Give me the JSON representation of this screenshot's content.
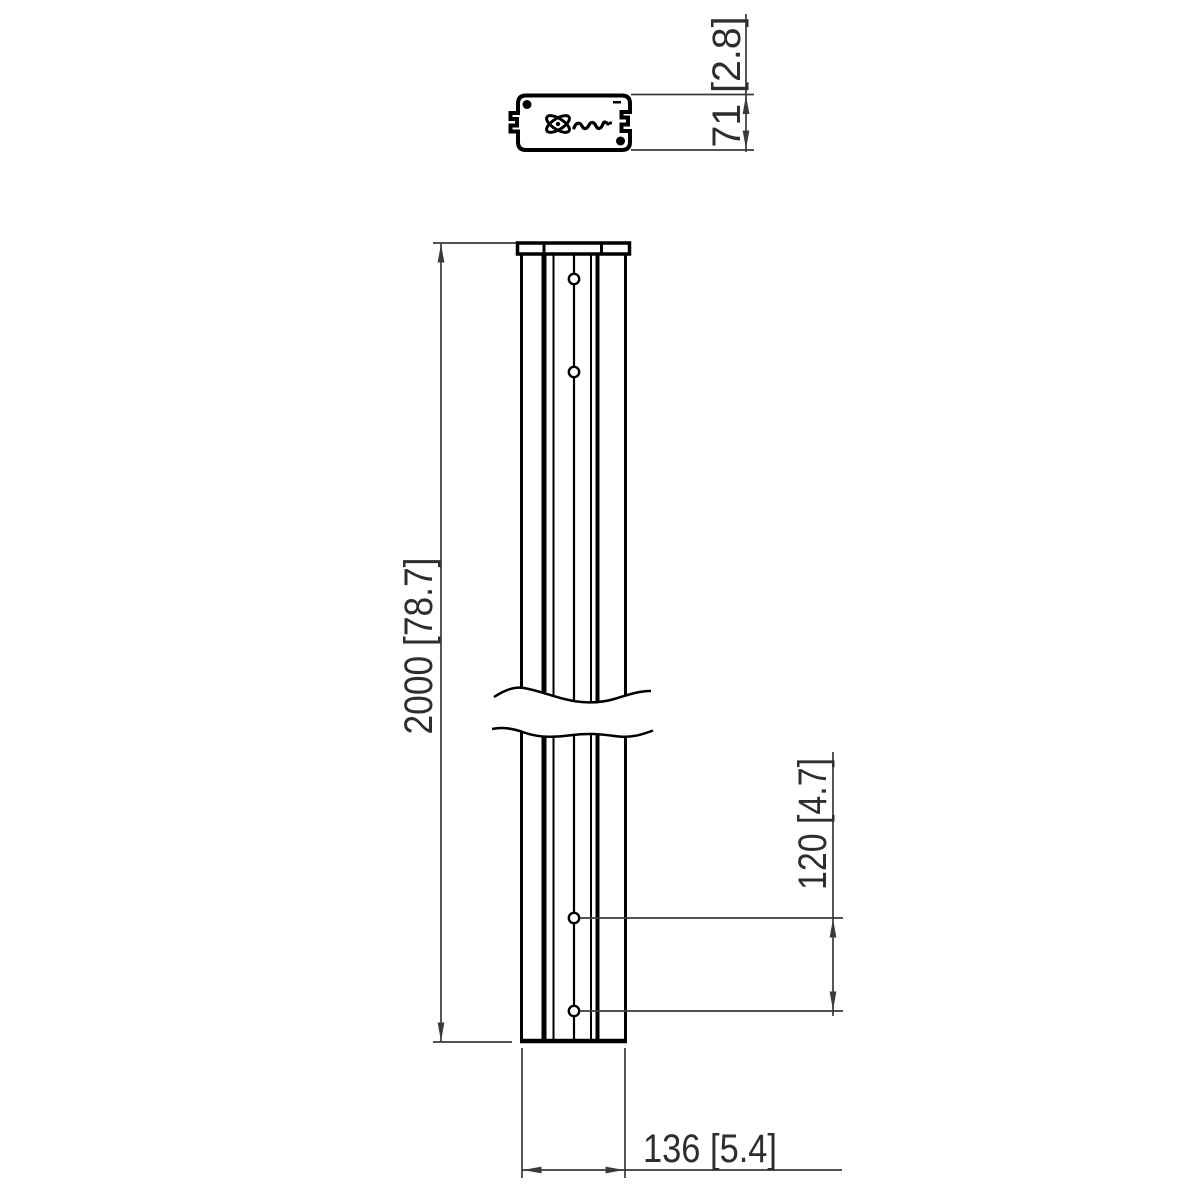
{
  "page": {
    "background": "#ffffff",
    "description": "Technical dimension drawing of a tall mounting column, top cross-section view and broken front view"
  },
  "colors": {
    "part_line": "#000000",
    "dimension_line": "#3a3a3a",
    "label_text": "#2e2e2e"
  },
  "top_view": {
    "logo": "vogels-logo",
    "dimension_depth": "71 [2.8]"
  },
  "front_view": {
    "dimension_height": "2000 [78.7]",
    "dimension_hole_spacing": "120 [4.7]",
    "dimension_width": "136 [5.4]",
    "visible_hole_count": "4"
  }
}
